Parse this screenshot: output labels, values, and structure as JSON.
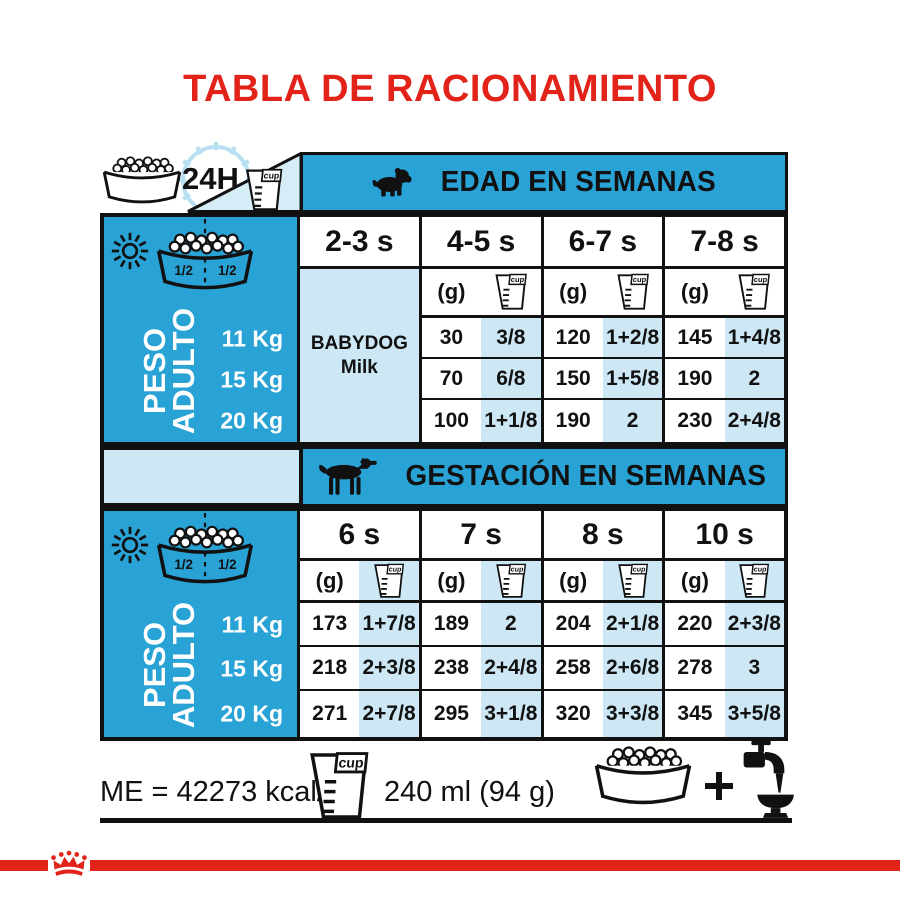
{
  "title": "TABLA DE RACIONAMIENTO",
  "colors": {
    "brand_red": "#E2231A",
    "table_blue": "#29A3D6",
    "pale_blue": "#CDE8F4",
    "ink": "#111111"
  },
  "legend": {
    "hours_label": "24H",
    "half_left": "1/2",
    "half_right": "1/2"
  },
  "units": {
    "grams": "(g)",
    "cup": "cup"
  },
  "sidebar": {
    "label_line1": "PESO",
    "label_line2": "ADULTO",
    "weights": [
      "11 Kg",
      "15 Kg",
      "20 Kg"
    ]
  },
  "age_table": {
    "header": "EDAD EN SEMANAS",
    "columns": [
      "2-3 s",
      "4-5 s",
      "6-7 s",
      "7-8 s"
    ],
    "first_column_note": {
      "line1": "BABYDOG",
      "line2": "Milk"
    },
    "rows": [
      {
        "weight": "11 Kg",
        "values": [
          [
            "30",
            "3/8"
          ],
          [
            "120",
            "1+2/8"
          ],
          [
            "145",
            "1+4/8"
          ]
        ]
      },
      {
        "weight": "15 Kg",
        "values": [
          [
            "70",
            "6/8"
          ],
          [
            "150",
            "1+5/8"
          ],
          [
            "190",
            "2"
          ]
        ]
      },
      {
        "weight": "20 Kg",
        "values": [
          [
            "100",
            "1+1/8"
          ],
          [
            "190",
            "2"
          ],
          [
            "230",
            "2+4/8"
          ]
        ]
      }
    ]
  },
  "gestation_table": {
    "header": "GESTACIÓN EN SEMANAS",
    "columns": [
      "6 s",
      "7 s",
      "8 s",
      "10 s"
    ],
    "rows": [
      {
        "weight": "11 Kg",
        "values": [
          [
            "173",
            "1+7/8"
          ],
          [
            "189",
            "2"
          ],
          [
            "204",
            "2+1/8"
          ],
          [
            "220",
            "2+3/8"
          ]
        ]
      },
      {
        "weight": "15 Kg",
        "values": [
          [
            "218",
            "2+3/8"
          ],
          [
            "238",
            "2+4/8"
          ],
          [
            "258",
            "2+6/8"
          ],
          [
            "278",
            "3"
          ]
        ]
      },
      {
        "weight": "20 Kg",
        "values": [
          [
            "271",
            "2+7/8"
          ],
          [
            "295",
            "3+1/8"
          ],
          [
            "320",
            "3+3/8"
          ],
          [
            "345",
            "3+5/8"
          ]
        ]
      }
    ]
  },
  "footer": {
    "energy": "ME = 42273 kcal/kg",
    "cup_volume": "240 ml (94 g)"
  },
  "icons": {
    "kibble_bowl": "dog-food-bowl",
    "measuring_cup": "cup",
    "clock": "24h-dial",
    "sun": "day",
    "moon": "night",
    "puppy": "puppy-silhouette",
    "adult_dog": "dog-silhouette",
    "water_tap": "tap-with-water-bowl",
    "plus": "plus-sign",
    "crown": "royal-canin-crown"
  }
}
